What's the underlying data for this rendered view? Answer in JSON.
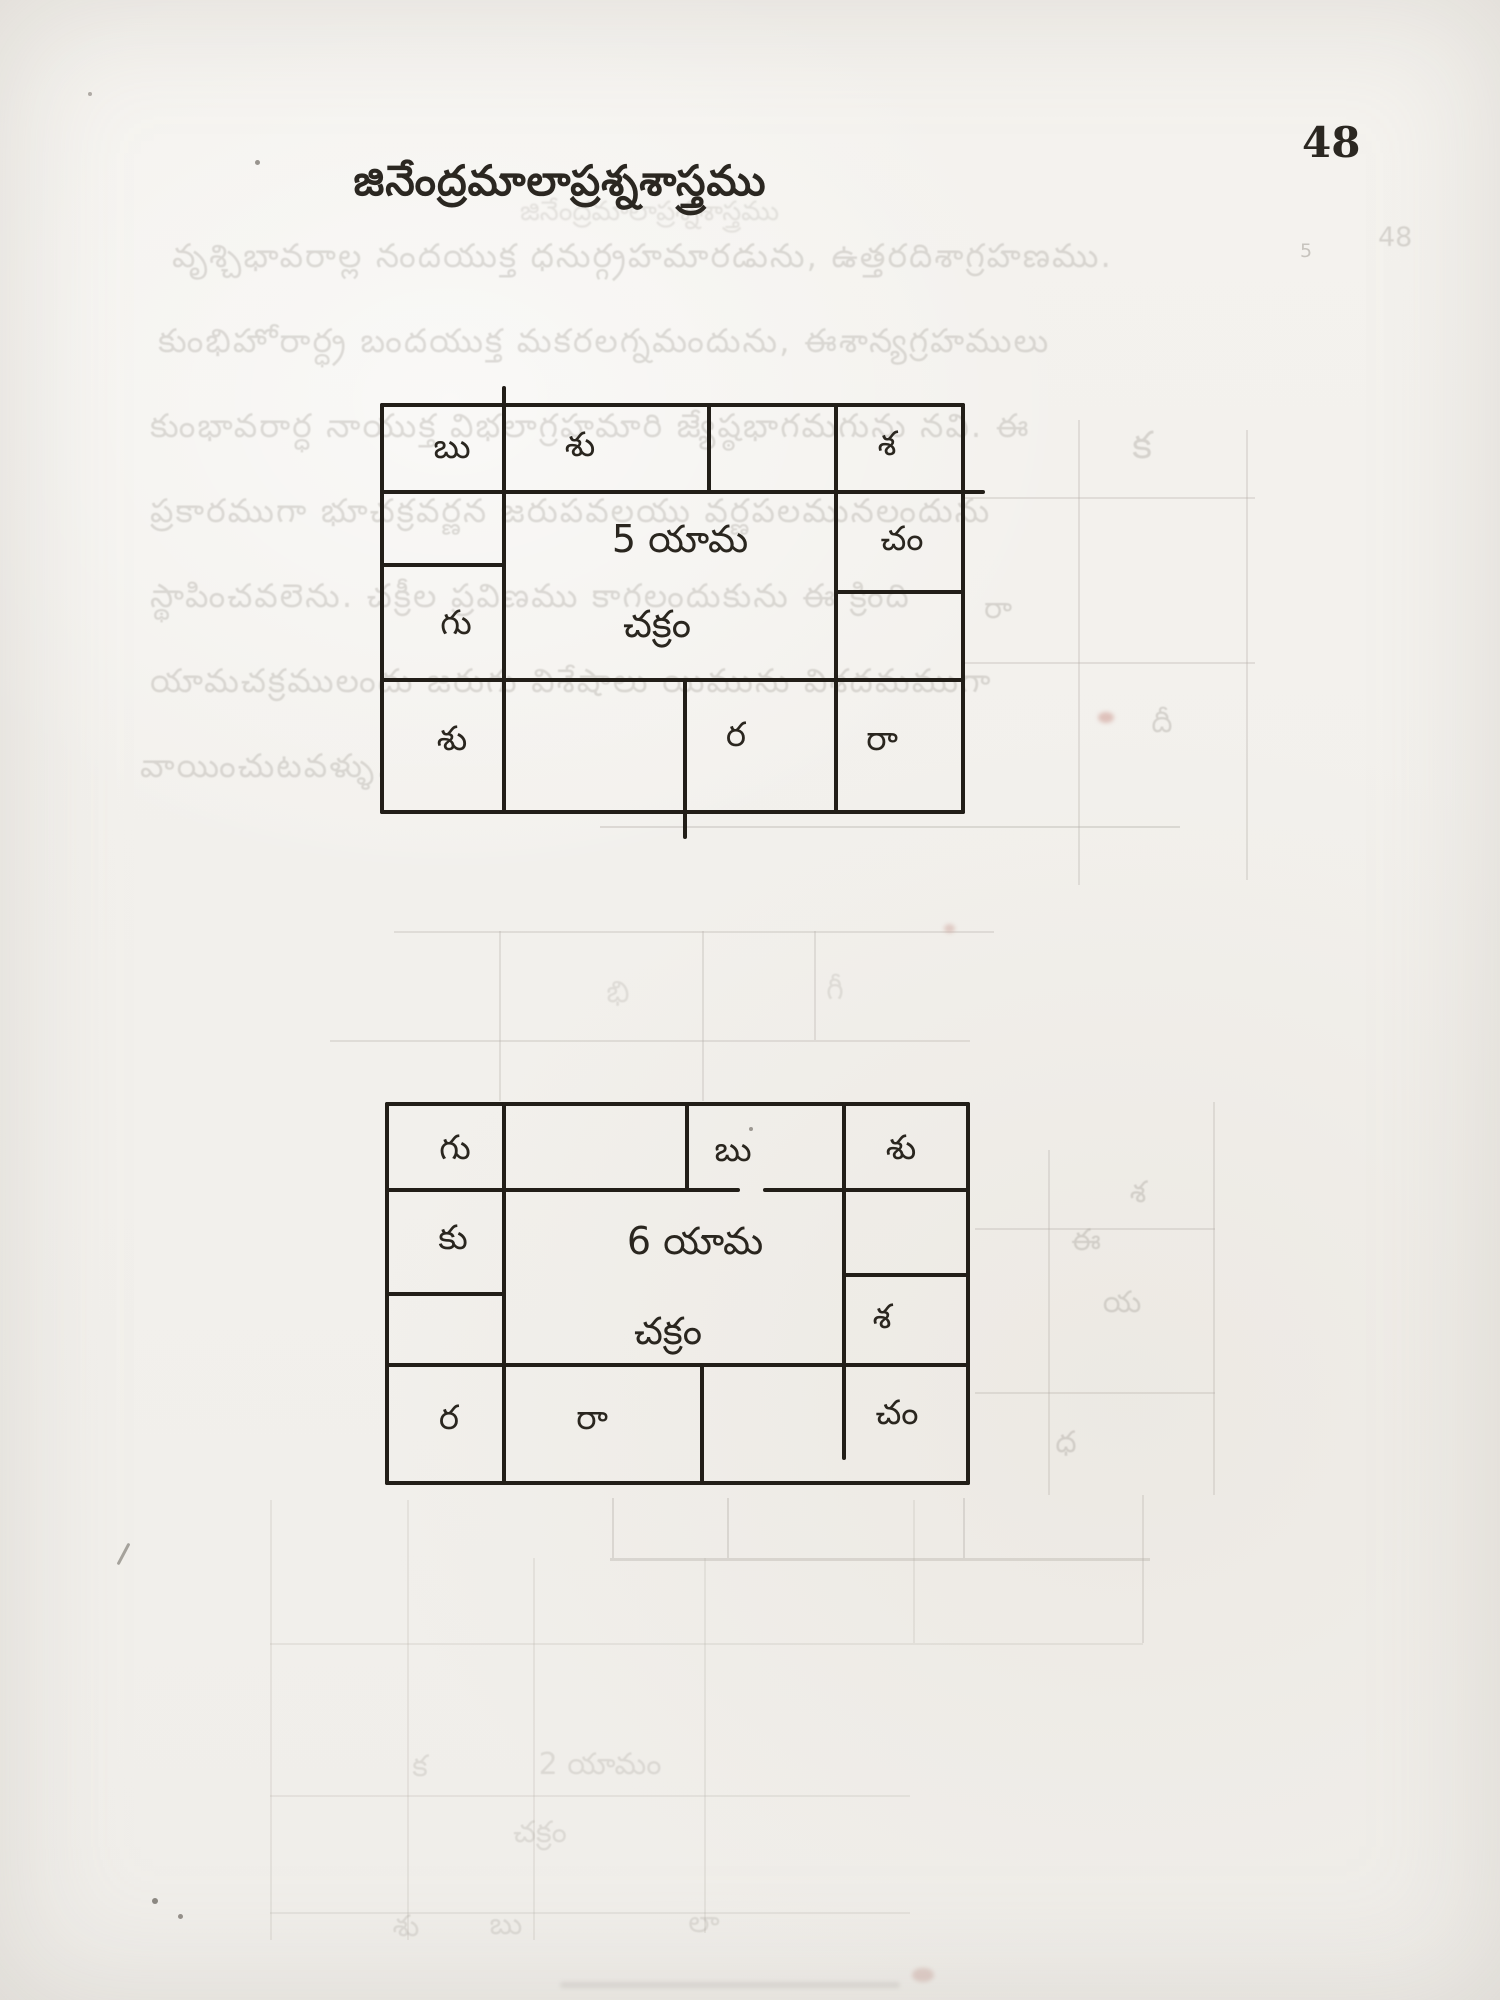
{
  "page": {
    "title": "జినేంద్రమాలాప్రశ్నశాస్త్రము",
    "page_number": "48",
    "paper_color": "#f3f1ed",
    "ink_color": "#242019"
  },
  "charts": [
    {
      "center": [
        "5 యామ",
        "చక్రం"
      ],
      "cells": {
        "top_row": [
          "బు",
          "శు",
          "",
          "శ"
        ],
        "mid_left": [
          "",
          "గు"
        ],
        "mid_right": [
          "చం",
          ""
        ],
        "bottom_row": [
          "శు",
          "",
          "ర",
          "రా"
        ]
      }
    },
    {
      "center": [
        "6 యామ",
        "చక్రం"
      ],
      "cells": {
        "top_row": [
          "గు",
          "",
          "బు",
          "శు"
        ],
        "mid_left": [
          "కు",
          ""
        ],
        "mid_right": [
          "",
          "శ"
        ],
        "bottom_row": [
          "ర",
          "రా",
          "",
          "చం"
        ]
      }
    }
  ],
  "ghosts": {
    "title_echo": "జినేంద్రమాలాప్రశ్నశాస్త్రము",
    "page_echo": "48",
    "page_echo_small": "5",
    "paragraph_lines": [
      "వృశ్చిభావరాల్ల నందయుక్త ధనుర్గ్రహమారడును, ఉత్తరదిశాగ్రహణము.",
      "కుంభిహోరార్ధ్ర బందయుక్త మకరలగ్నమందును, ఈశాన్యగ్రహములు",
      "కుంభావరార్ధ నాయుక్త విభలాగ్రహమారి జ్యేష్ఠభాగమగును నవి. ఈ",
      "ప్రకారముగా భూచక్రవర్ణన జరుపవలయు వర్ణపలమునలందును",
      "స్థాపించవలెను. చక్రీల ప్రవిణము కాగలందుకును ఈ క్రింది",
      "యామచక్రములందు జరుగు విశేషాలు యిమును విశదమముగా",
      "వాయించుటవళ్ళు."
    ],
    "glyphs": [
      {
        "text": "క"
      },
      {
        "text": "రా"
      },
      {
        "text": "దీ"
      },
      {
        "text": "భి"
      },
      {
        "text": "గీ"
      },
      {
        "text": "శ"
      },
      {
        "text": "ఈ"
      },
      {
        "text": "య"
      },
      {
        "text": "ధ"
      },
      {
        "text": "క"
      },
      {
        "text": "2 యామం"
      },
      {
        "text": "చక్రం"
      },
      {
        "text": "శు"
      },
      {
        "text": "బు"
      },
      {
        "text": "లా"
      }
    ]
  }
}
